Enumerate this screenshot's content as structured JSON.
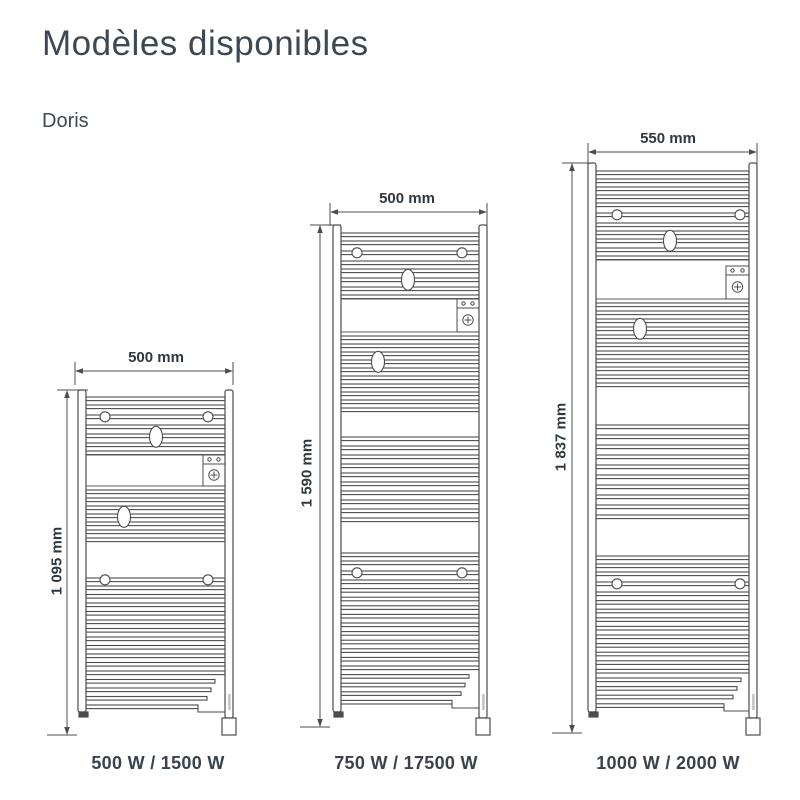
{
  "header": {
    "title": "Modèles disponibles",
    "model_family": "Doris"
  },
  "models": [
    {
      "width_label": "500 mm",
      "height_label": "1 095 mm",
      "power_label": "500 W / 1500 W"
    },
    {
      "width_label": "500 mm",
      "height_label": "1 590 mm",
      "power_label": "750 W / 17500 W"
    },
    {
      "width_label": "550 mm",
      "height_label": "1 837 mm",
      "power_label": "1000 W / 2000 W"
    }
  ],
  "icons": {
    "control_panel": "control-panel-icon",
    "regulator": "regulator-knob-icon",
    "leds": "led-dots-icon"
  },
  "colors": {
    "text": "#3e4852",
    "line": "#4d4d4d",
    "power_text": "#39424d"
  }
}
